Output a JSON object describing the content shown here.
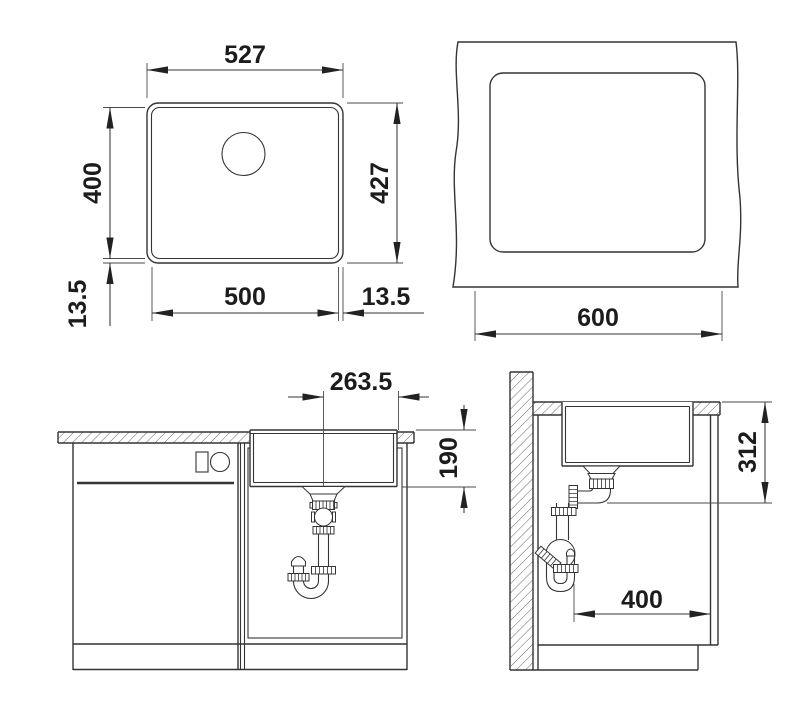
{
  "colors": {
    "line": "#343434",
    "text": "#1c1c1c",
    "background": "#ffffff"
  },
  "views": {
    "top": {
      "outer_width": "527",
      "outer_height": "427",
      "inner_height": "400",
      "inner_width": "500",
      "rim_bottom": "13.5",
      "rim_side": "13.5"
    },
    "cutout": {
      "cabinet_width": "600"
    },
    "front": {
      "drain_to_edge": "263.5",
      "bowl_depth": "190"
    },
    "side": {
      "depth_to_outlet": "312",
      "cabinet_depth": "400"
    }
  }
}
